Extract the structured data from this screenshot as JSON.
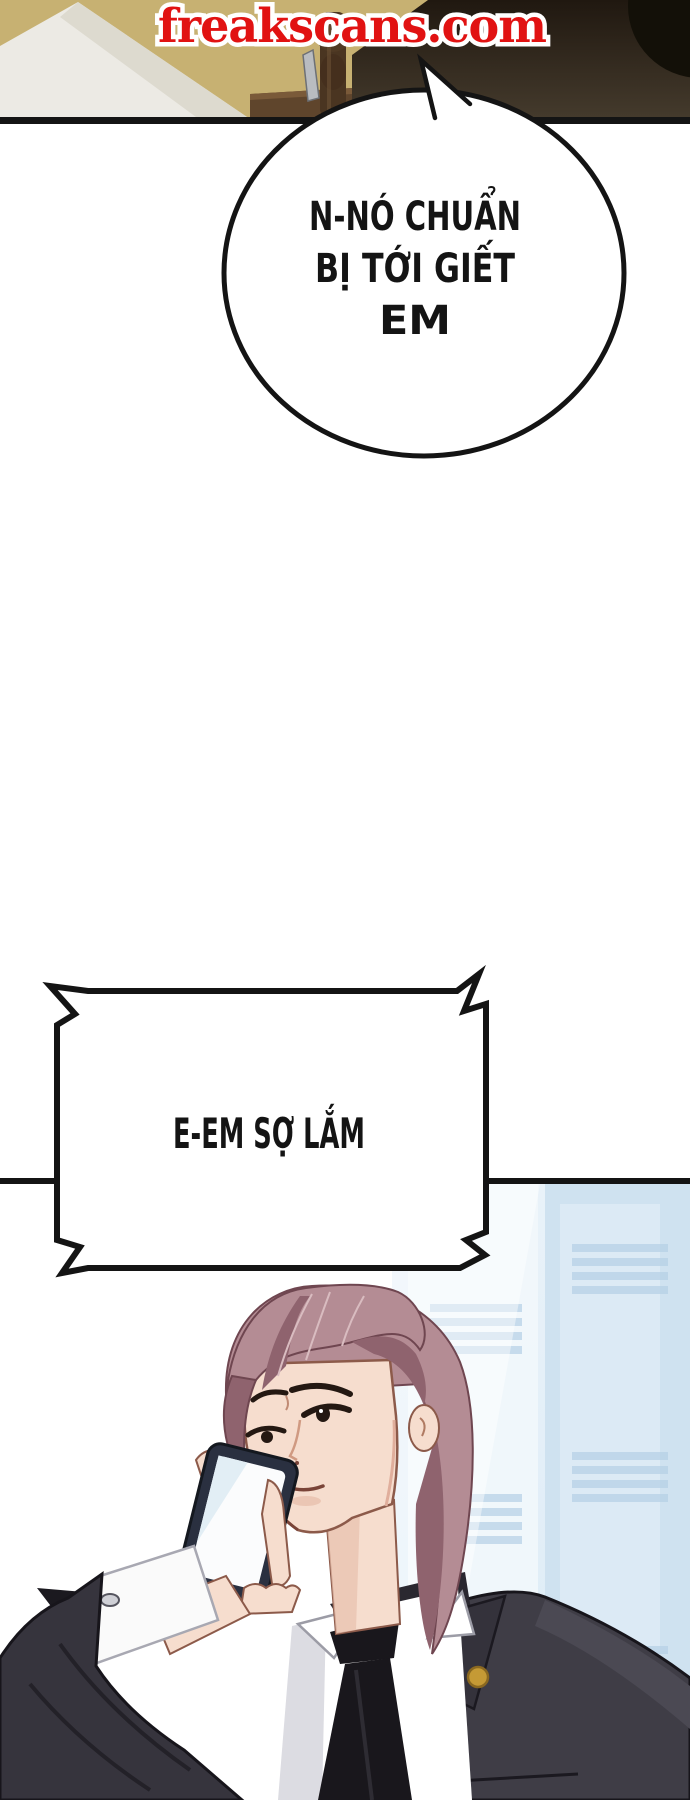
{
  "site_banner": {
    "text": "freakscans.com"
  },
  "speech_bubble": {
    "lines": [
      "N-NÓ CHUẨN",
      "BỊ TỚI GIẾT",
      "EM"
    ]
  },
  "shout_box": {
    "text": "E-EM SỢ LẮM"
  },
  "colors": {
    "accent-red": "#e11212",
    "ink": "#141414",
    "wall-tan": "#c7b172",
    "prop-white": "#eceae4",
    "dark-mass": "#2a2116",
    "hair-base": "#b48c94",
    "hair-shadow": "#8f636e",
    "skin": "#f6ddce",
    "skin-shadow": "#e8c0ae",
    "suit-base": "#3f3d46",
    "suit-shadow": "#2a2830",
    "tie-black": "#19171c",
    "shirt-white": "#ffffff",
    "phone-body": "#2a3040",
    "phone-screen": "#fbfcfd",
    "pin-gold": "#c59a35",
    "window-blue": "#cfe2f0",
    "window-light": "#e9f2f9"
  }
}
